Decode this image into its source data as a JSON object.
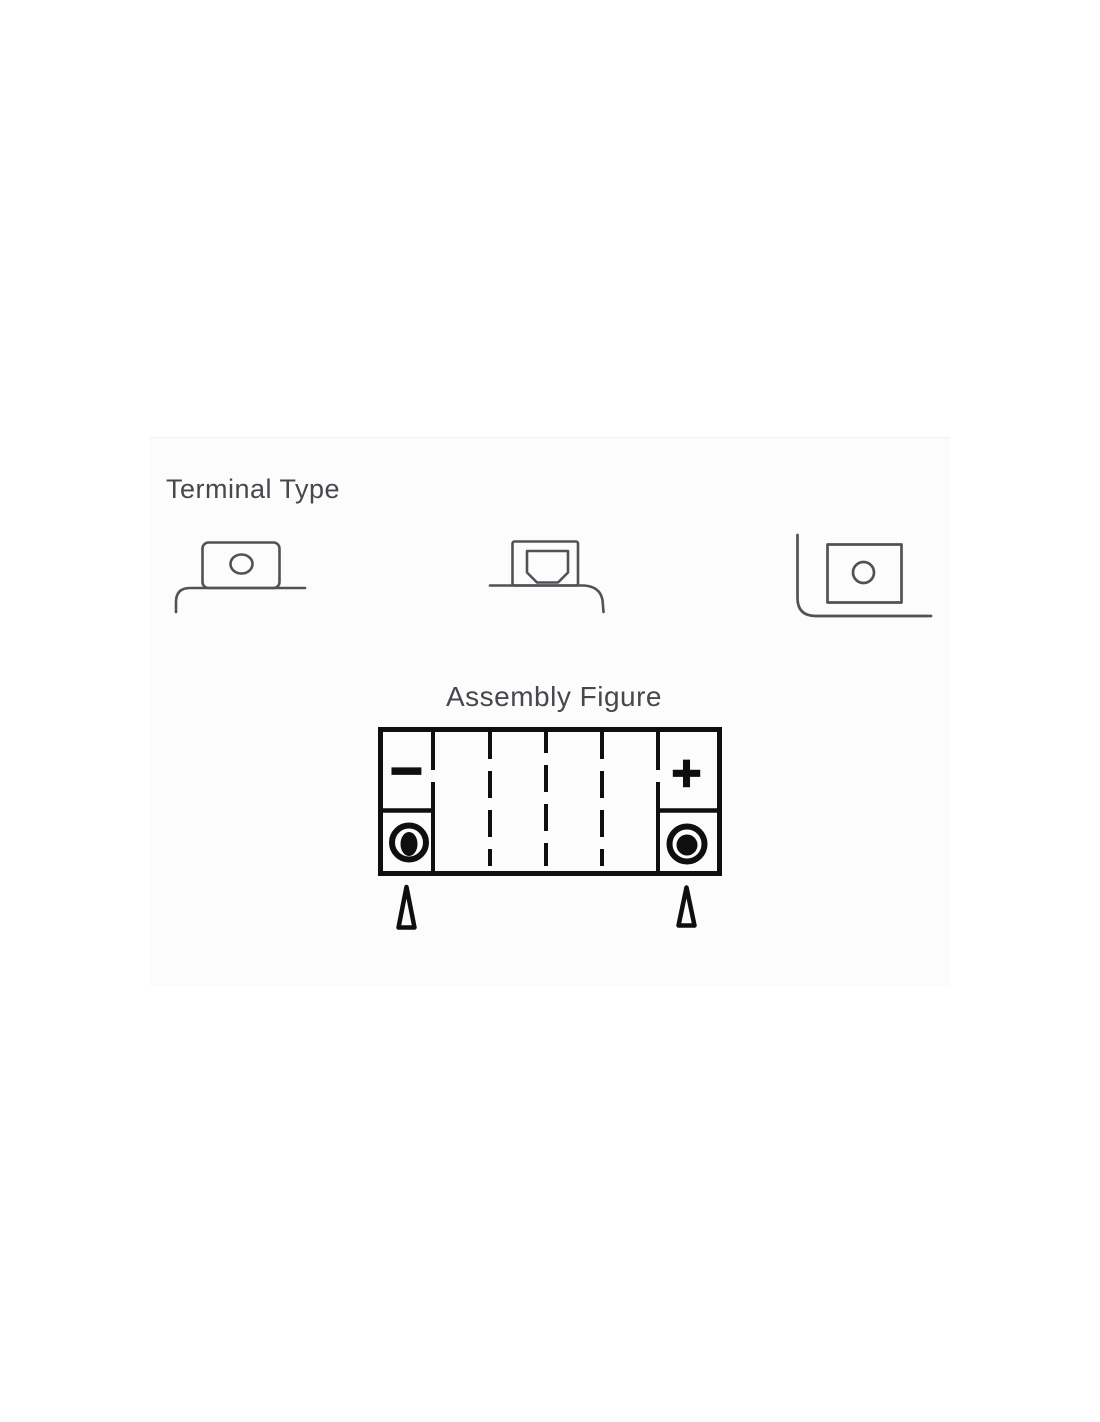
{
  "page": {
    "background": "#ffffff"
  },
  "panel": {
    "background": "#fcfcfc"
  },
  "terminal_type_section": {
    "title": "Terminal Type",
    "icons": [
      {
        "id": "terminal-style-top-round-hole"
      },
      {
        "id": "terminal-style-top-nut-recess"
      },
      {
        "id": "terminal-style-side-round-hole"
      }
    ]
  },
  "assembly_figure_section": {
    "title": "Assembly Figure",
    "negative_label": "−",
    "positive_label": "+",
    "cell_count": 6
  },
  "colors": {
    "heading_text": "#47474d",
    "terminal_icon_line": "#515157",
    "assembly_line": "#0f0f0f"
  }
}
